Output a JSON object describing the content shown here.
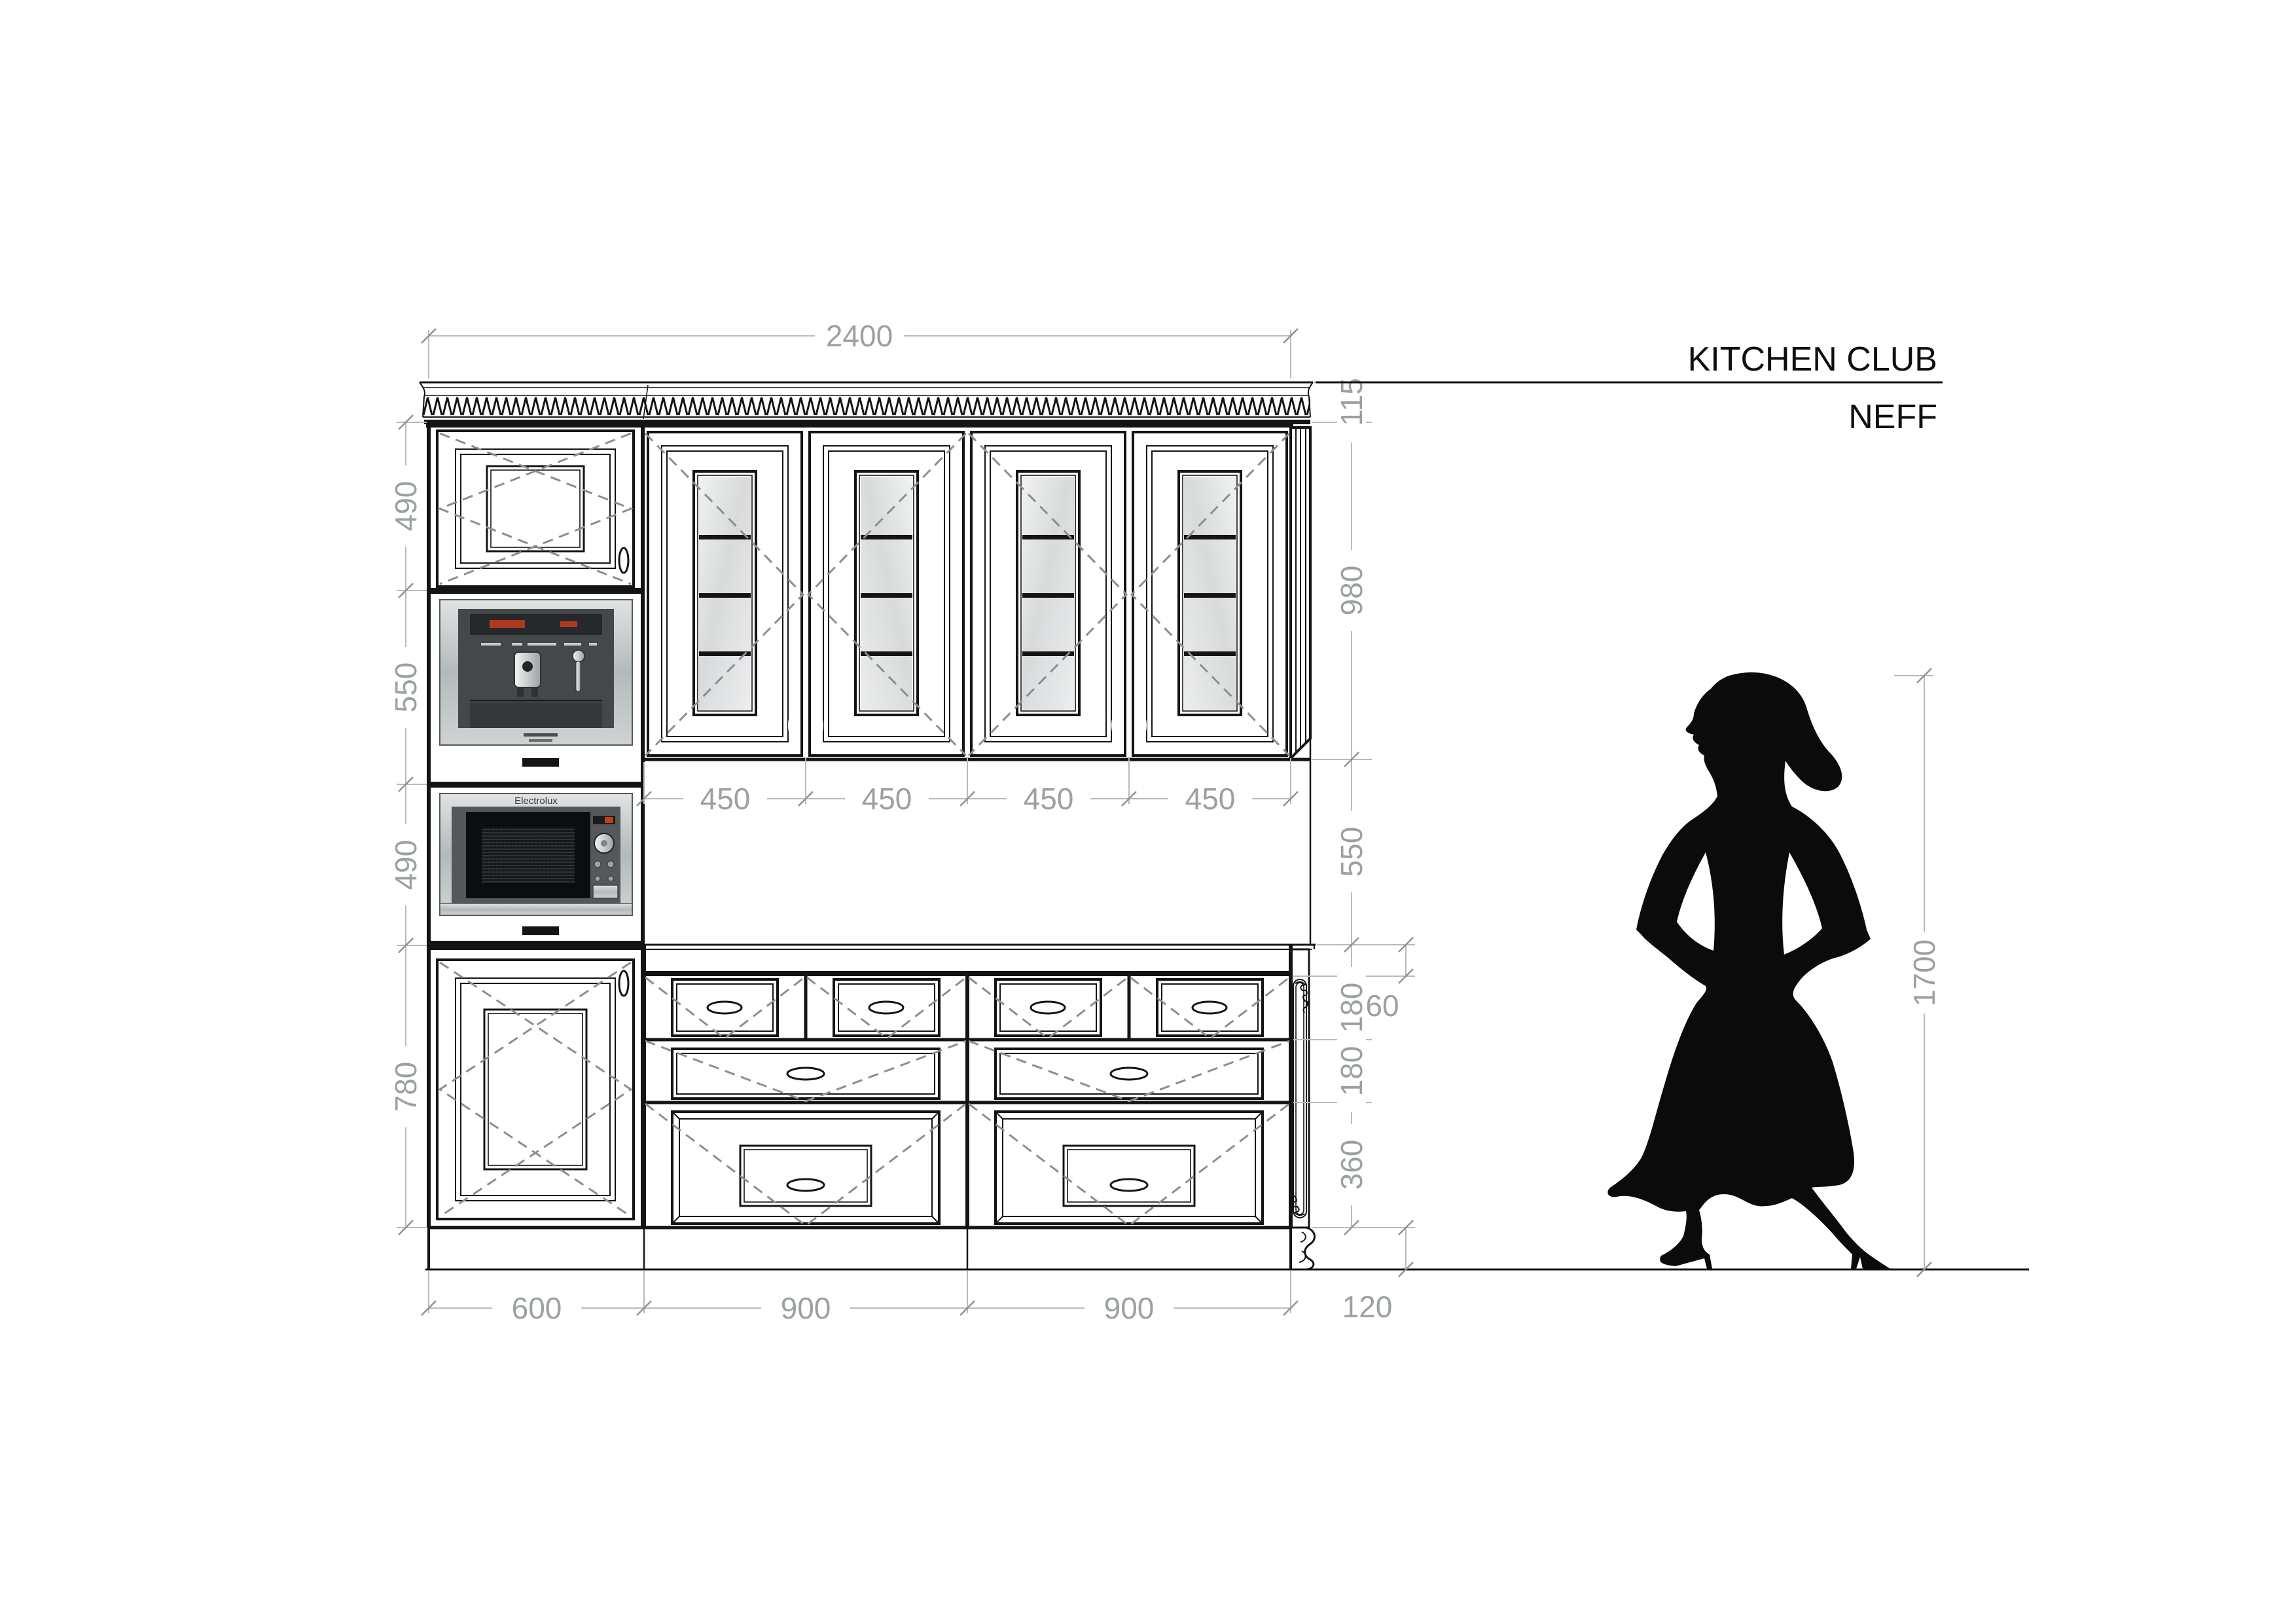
{
  "header": {
    "studio": "KITCHEN CLUB",
    "brand": "NEFF"
  },
  "appliances": {
    "microwave_brand": "Electrolux"
  },
  "dimensions": {
    "overall_width": "2400",
    "cornice_height": "115",
    "wall_cabinet_height": "980",
    "splashback_height": "550",
    "wall_door_widths": [
      "450",
      "450",
      "450",
      "450"
    ],
    "left_heights": [
      "490",
      "550",
      "490",
      "780"
    ],
    "counter_thickness": "60",
    "drawer_heights": [
      "180",
      "180",
      "360"
    ],
    "plinth_height": "120",
    "base_widths": [
      "600",
      "900",
      "900"
    ],
    "figure_height": "1700"
  }
}
